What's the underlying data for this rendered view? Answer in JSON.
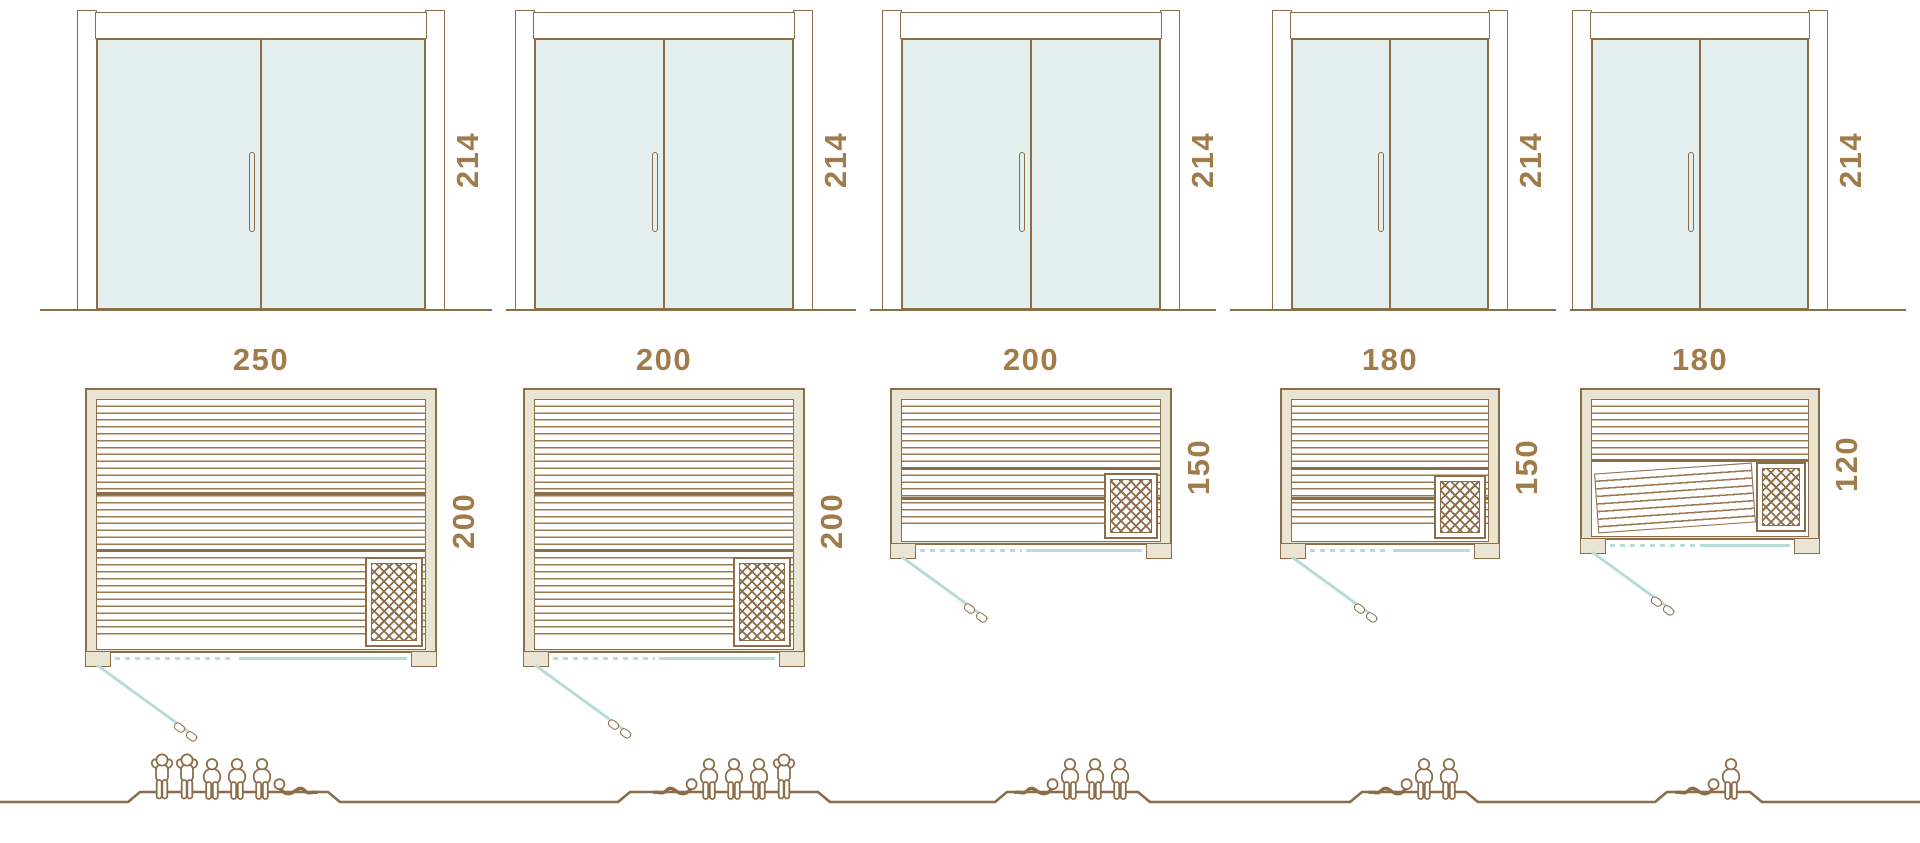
{
  "title": "sauna-size-comparison-diagram",
  "colors": {
    "stroke": "#8c6d49",
    "slat": "#9a7a52",
    "label_text": "#a17c4b",
    "wall_beige": "#eae5d2",
    "glass_teal": "#e2efec",
    "door_swing_teal": "#b7dcd8",
    "background": "#ffffff"
  },
  "icons": [
    "door-elevation",
    "door-handle-icon",
    "heater-icon",
    "wall-stub",
    "door-swing-line",
    "person-standing-icon",
    "person-sitting-icon",
    "person-lying-icon",
    "ground-line"
  ],
  "saunas": [
    {
      "name": "sauna-250x200",
      "height_label": "214",
      "width_label": "250",
      "depth_label": "200",
      "capacity": 6,
      "door": {
        "x": 77,
        "w": 368
      },
      "plan": {
        "x": 85,
        "y": 388,
        "w": 352,
        "h": 265,
        "type": "standard",
        "dividers": [
          0.38,
          0.62
        ],
        "heater": {
          "w": 58,
          "h": 90
        }
      },
      "swing": {
        "len": 110,
        "dash_frac": 0.34
      },
      "ground_segment": [
        40,
        492
      ],
      "people": {
        "plateau": [
          128,
          340
        ],
        "figures": [
          "stand",
          "stand",
          "sit",
          "sit",
          "sit",
          "lie-r"
        ]
      }
    },
    {
      "name": "sauna-200x200",
      "height_label": "214",
      "width_label": "200",
      "depth_label": "200",
      "capacity": 5,
      "door": {
        "x": 515,
        "w": 298
      },
      "plan": {
        "x": 523,
        "y": 388,
        "w": 282,
        "h": 265,
        "type": "standard",
        "dividers": [
          0.38,
          0.62
        ],
        "heater": {
          "w": 58,
          "h": 90
        }
      },
      "swing": {
        "len": 105,
        "dash_frac": 0.36
      },
      "ground_segment": [
        506,
        856
      ],
      "people": {
        "plateau": [
          618,
          830
        ],
        "figures": [
          "lie-l",
          "sit",
          "sit",
          "sit",
          "stand"
        ]
      }
    },
    {
      "name": "sauna-200x150",
      "height_label": "214",
      "width_label": "200",
      "depth_label": "150",
      "capacity": 4,
      "door": {
        "x": 882,
        "w": 298
      },
      "plan": {
        "x": 890,
        "y": 388,
        "w": 282,
        "h": 157,
        "type": "standard",
        "dividers": [
          0.5,
          0.73
        ],
        "heater": {
          "w": 54,
          "h": 66
        }
      },
      "swing": {
        "len": 92,
        "dash_frac": 0.36
      },
      "ground_segment": [
        870,
        1216
      ],
      "people": {
        "plateau": [
          995,
          1150
        ],
        "figures": [
          "lie-l",
          "sit",
          "sit",
          "sit"
        ]
      }
    },
    {
      "name": "sauna-180x150",
      "height_label": "214",
      "width_label": "180",
      "depth_label": "150",
      "capacity": 3,
      "door": {
        "x": 1272,
        "w": 236
      },
      "plan": {
        "x": 1280,
        "y": 388,
        "w": 220,
        "h": 157,
        "type": "standard",
        "dividers": [
          0.5,
          0.73
        ],
        "heater": {
          "w": 52,
          "h": 64
        }
      },
      "swing": {
        "len": 92,
        "dash_frac": 0.36
      },
      "ground_segment": [
        1230,
        1556
      ],
      "people": {
        "plateau": [
          1350,
          1478
        ],
        "figures": [
          "lie-l",
          "sit",
          "sit"
        ]
      }
    },
    {
      "name": "sauna-180x120",
      "height_label": "214",
      "width_label": "180",
      "depth_label": "120",
      "capacity": 2,
      "door": {
        "x": 1572,
        "w": 256
      },
      "plan": {
        "x": 1580,
        "y": 388,
        "w": 240,
        "h": 152,
        "type": "lounger",
        "dividers": [
          0.46
        ],
        "heater": {
          "w": 50,
          "h": 70
        },
        "lounger": {
          "w": 158,
          "h": 60,
          "angle": -4
        }
      },
      "swing": {
        "len": 88,
        "dash_frac": 0.36
      },
      "ground_segment": [
        1570,
        1906
      ],
      "people": {
        "plateau": [
          1655,
          1762
        ],
        "figures": [
          "lie-l",
          "sit"
        ]
      }
    }
  ],
  "rows": {
    "elevation_top": 10,
    "elevation_height": 300,
    "elevation_ground_y": 309,
    "plan_label_y": 344,
    "people_baseline_y": 802,
    "people_plateau_rise": 10
  }
}
